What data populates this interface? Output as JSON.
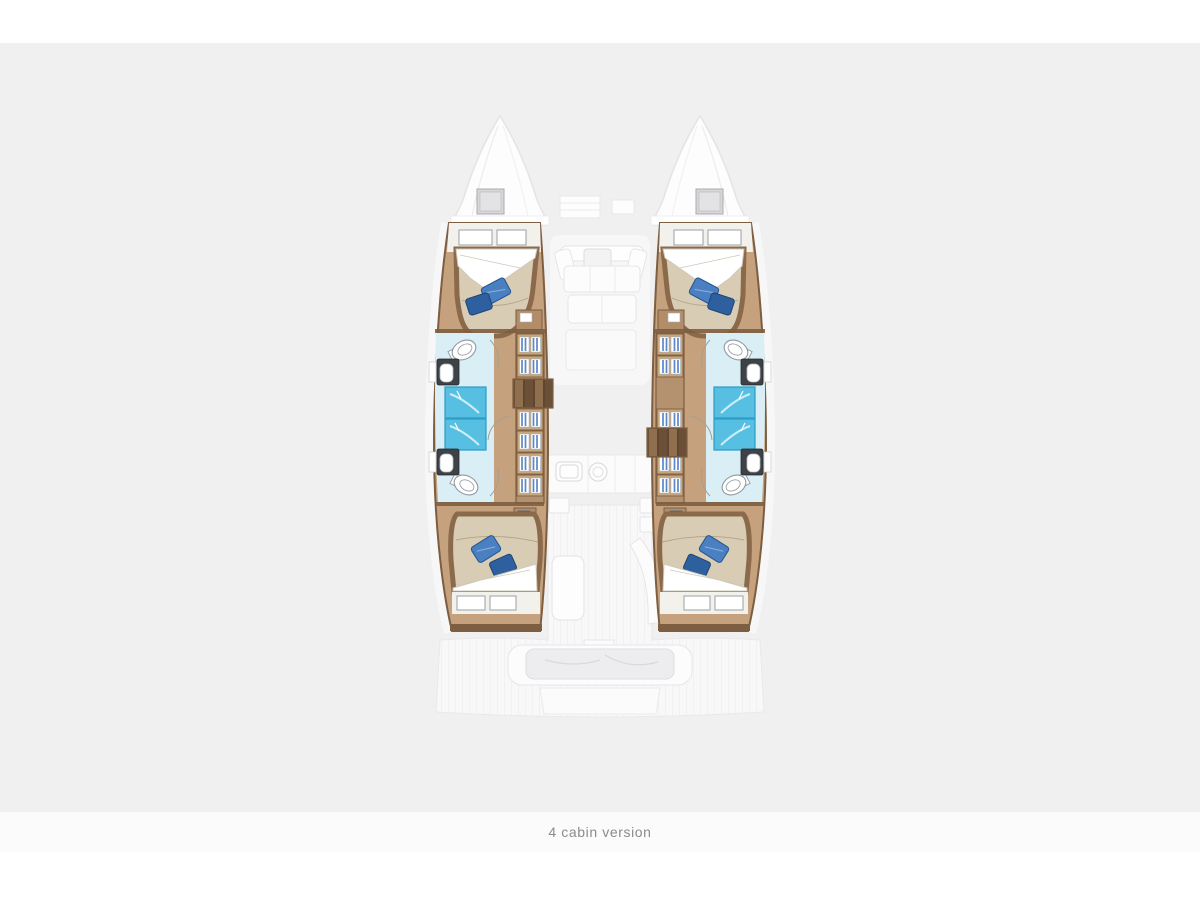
{
  "caption": {
    "text": "4 cabin version"
  },
  "plan": {
    "type": "catamaran-floorplan",
    "components": [
      "bow-hatch",
      "double-bed",
      "pillow",
      "wardrobe-shelves",
      "companionway-steps",
      "shower",
      "toilet",
      "sink",
      "saloon-sofa",
      "galley",
      "cockpit-table",
      "stern-platform"
    ]
  },
  "colors": {
    "bg": "#f0f0f1",
    "strip": "#ffffff",
    "caption_band": "#fbfbfc",
    "caption_text": "#8b8b8b",
    "ghost_fill": "#fbfbfc",
    "ghost_line": "#e4e4e7",
    "hull_wood": "#c5a17e",
    "wood_dark": "#7d5e41",
    "trim": "#8a6a4a",
    "mattress": "#d9ccb4",
    "mattress_line": "#b3a284",
    "sheet": "#ffffff",
    "sheet_line": "#cfc8b8",
    "pillow_dark": "#2e5f9e",
    "pillow_mid": "#4a7fc1",
    "bath_floor": "#daeef6",
    "shower": "#57c0e2",
    "shower_edge": "#2c9dc5",
    "fixture": "#ffffff",
    "fixture_line": "#8f979e",
    "counter_dark": "#3d4246",
    "hatch": "#d7d7d9",
    "hatch_line": "#ababad",
    "step_light": "#8f6f4d",
    "step_dark": "#6b4f36",
    "shelf_blue": "#5d87c4",
    "shelf_bg": "#b5926f",
    "shelf_face": "#c7a67e",
    "band_wall": "#f3f1ec"
  }
}
